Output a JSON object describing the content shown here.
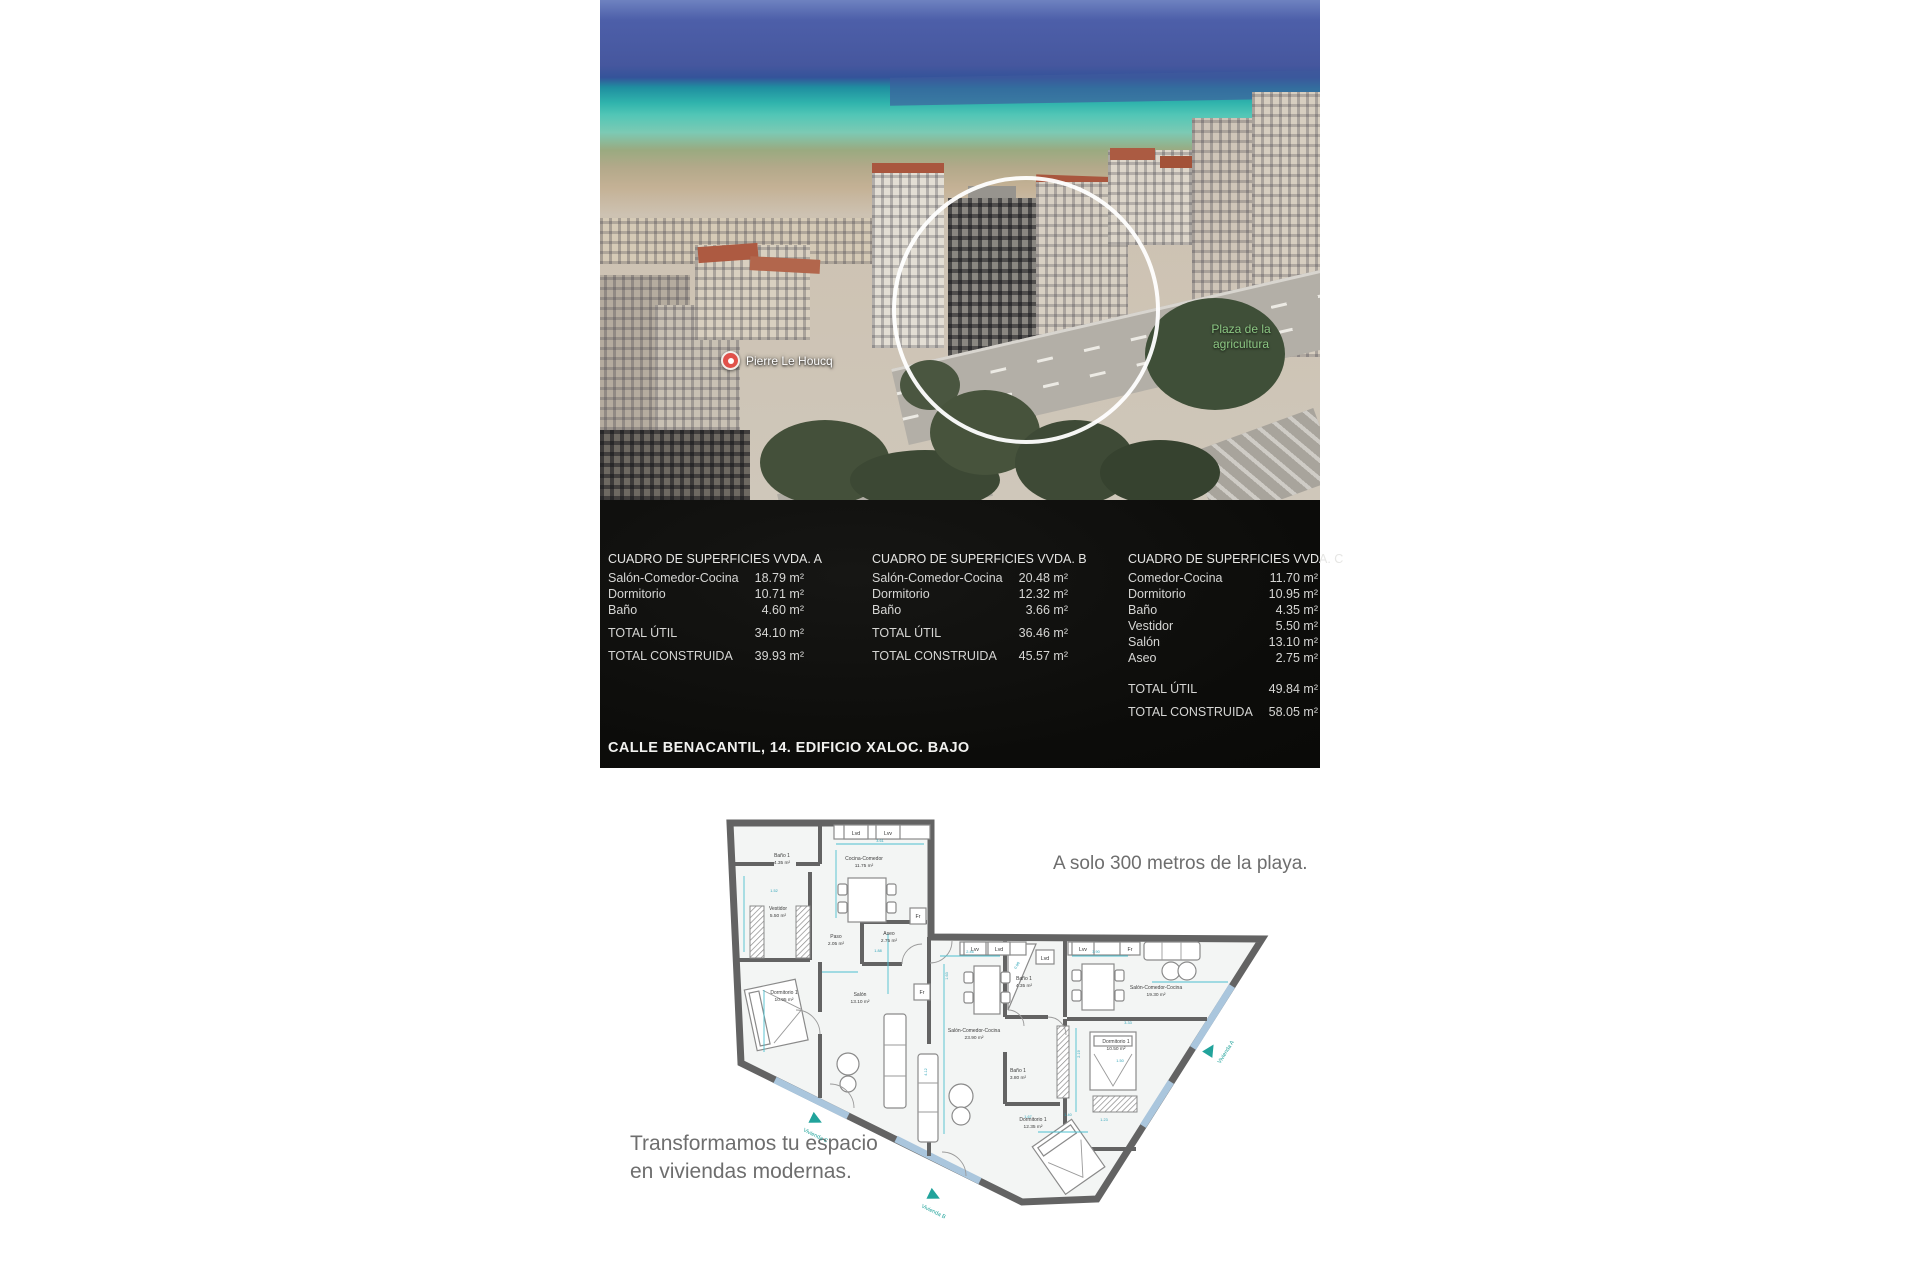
{
  "photo": {
    "poi_label": "Pierre Le Houcq",
    "park_label_line1": "Plaza de la",
    "park_label_line2": "agricultura"
  },
  "surfaces_panel": {
    "address": "CALLE BENACANTIL, 14. EDIFICIO XALOC. BAJO",
    "total_util_label": "TOTAL ÚTIL",
    "total_construida_label": "TOTAL CONSTRUIDA",
    "tables": [
      {
        "title": "CUADRO DE SUPERFICIES VVDA. A",
        "rows": [
          {
            "label": "Salón-Comedor-Cocina",
            "value": "18.79 m²"
          },
          {
            "label": "Dormitorio",
            "value": "10.71 m²"
          },
          {
            "label": "Baño",
            "value": "4.60 m²"
          }
        ],
        "total_util": "34.10 m²",
        "total_construida": "39.93 m²"
      },
      {
        "title": "CUADRO DE SUPERFICIES VVDA. B",
        "rows": [
          {
            "label": "Salón-Comedor-Cocina",
            "value": "20.48 m²"
          },
          {
            "label": "Dormitorio",
            "value": "12.32 m²"
          },
          {
            "label": "Baño",
            "value": "3.66 m²"
          }
        ],
        "total_util": "36.46 m²",
        "total_construida": "45.57 m²"
      },
      {
        "title": "CUADRO DE SUPERFICIES VVDA. C",
        "rows": [
          {
            "label": "Comedor-Cocina",
            "value": "11.70 m²"
          },
          {
            "label": "Dormitorio",
            "value": "10.95 m²"
          },
          {
            "label": "Baño",
            "value": "4.35 m²"
          },
          {
            "label": "Vestidor",
            "value": "5.50 m²"
          },
          {
            "label": "Salón",
            "value": "13.10 m²"
          },
          {
            "label": "Aseo",
            "value": "2.75 m²"
          }
        ],
        "total_util": "49.84 m²",
        "total_construida": "58.05 m²"
      }
    ]
  },
  "taglines": {
    "beach": "A solo 300 metros de la playa.",
    "transform_line1": "Transformamos tu espacio",
    "transform_line2": "en viviendas modernas."
  },
  "floorplan": {
    "rooms": [
      {
        "name": "Baño 1",
        "area": "4.35 m²"
      },
      {
        "name": "Vestidor",
        "area": "5.50 m²"
      },
      {
        "name": "Cocina-Comedor",
        "area": "11.75 m²"
      },
      {
        "name": "Paso",
        "area": "2.05 m²"
      },
      {
        "name": "Aseo",
        "area": "2.75 m²"
      },
      {
        "name": "Dormitorio 1",
        "area": "10.95 m²"
      },
      {
        "name": "Salón",
        "area": "13.10 m²"
      },
      {
        "name": "Salón-Comedor-Cocina",
        "area": "23.90 m²"
      },
      {
        "name": "Baño 1",
        "area": "4.35 m²"
      },
      {
        "name": "Baño 1",
        "area": "3.80 m²"
      },
      {
        "name": "Dormitorio 1",
        "area": "10.50 m²"
      },
      {
        "name": "Salón-Comedor-Cocina",
        "area": "19.30 m²"
      },
      {
        "name": "Dormitorio 1",
        "area": "12.35 m²"
      }
    ],
    "appliances": [
      {
        "label": "Lvd"
      },
      {
        "label": "Lvv"
      },
      {
        "label": "Fr"
      },
      {
        "label": "Fr"
      },
      {
        "label": "Lvv"
      },
      {
        "label": "Lvd"
      },
      {
        "label": "Lvd"
      },
      {
        "label": "Lvv"
      },
      {
        "label": "Fr"
      }
    ],
    "dims": [
      {
        "v": "3.61"
      },
      {
        "v": "1.52"
      },
      {
        "v": "1.88"
      },
      {
        "v": "2.46"
      },
      {
        "v": "1.63"
      },
      {
        "v": "3.90"
      },
      {
        "v": "0.96"
      },
      {
        "v": "4.12"
      },
      {
        "v": "3.33"
      },
      {
        "v": "2.19"
      },
      {
        "v": "1.50"
      },
      {
        "v": "1.67"
      },
      {
        "v": "1.40"
      },
      {
        "v": "1.23"
      }
    ],
    "unit_markers": [
      {
        "label": "Vivienda C"
      },
      {
        "label": "Vivienda B"
      },
      {
        "label": "Vivienda A"
      }
    ]
  },
  "colors": {
    "sea_deep": "#46579e",
    "sea_turquoise": "#2fb3ac",
    "sand": "#c4b195",
    "panel_bg": "#0c0c0a",
    "accent_cyan": "#4cc0cf",
    "marker_teal": "#21a39b",
    "tagline_gray": "#6e6e6e"
  }
}
